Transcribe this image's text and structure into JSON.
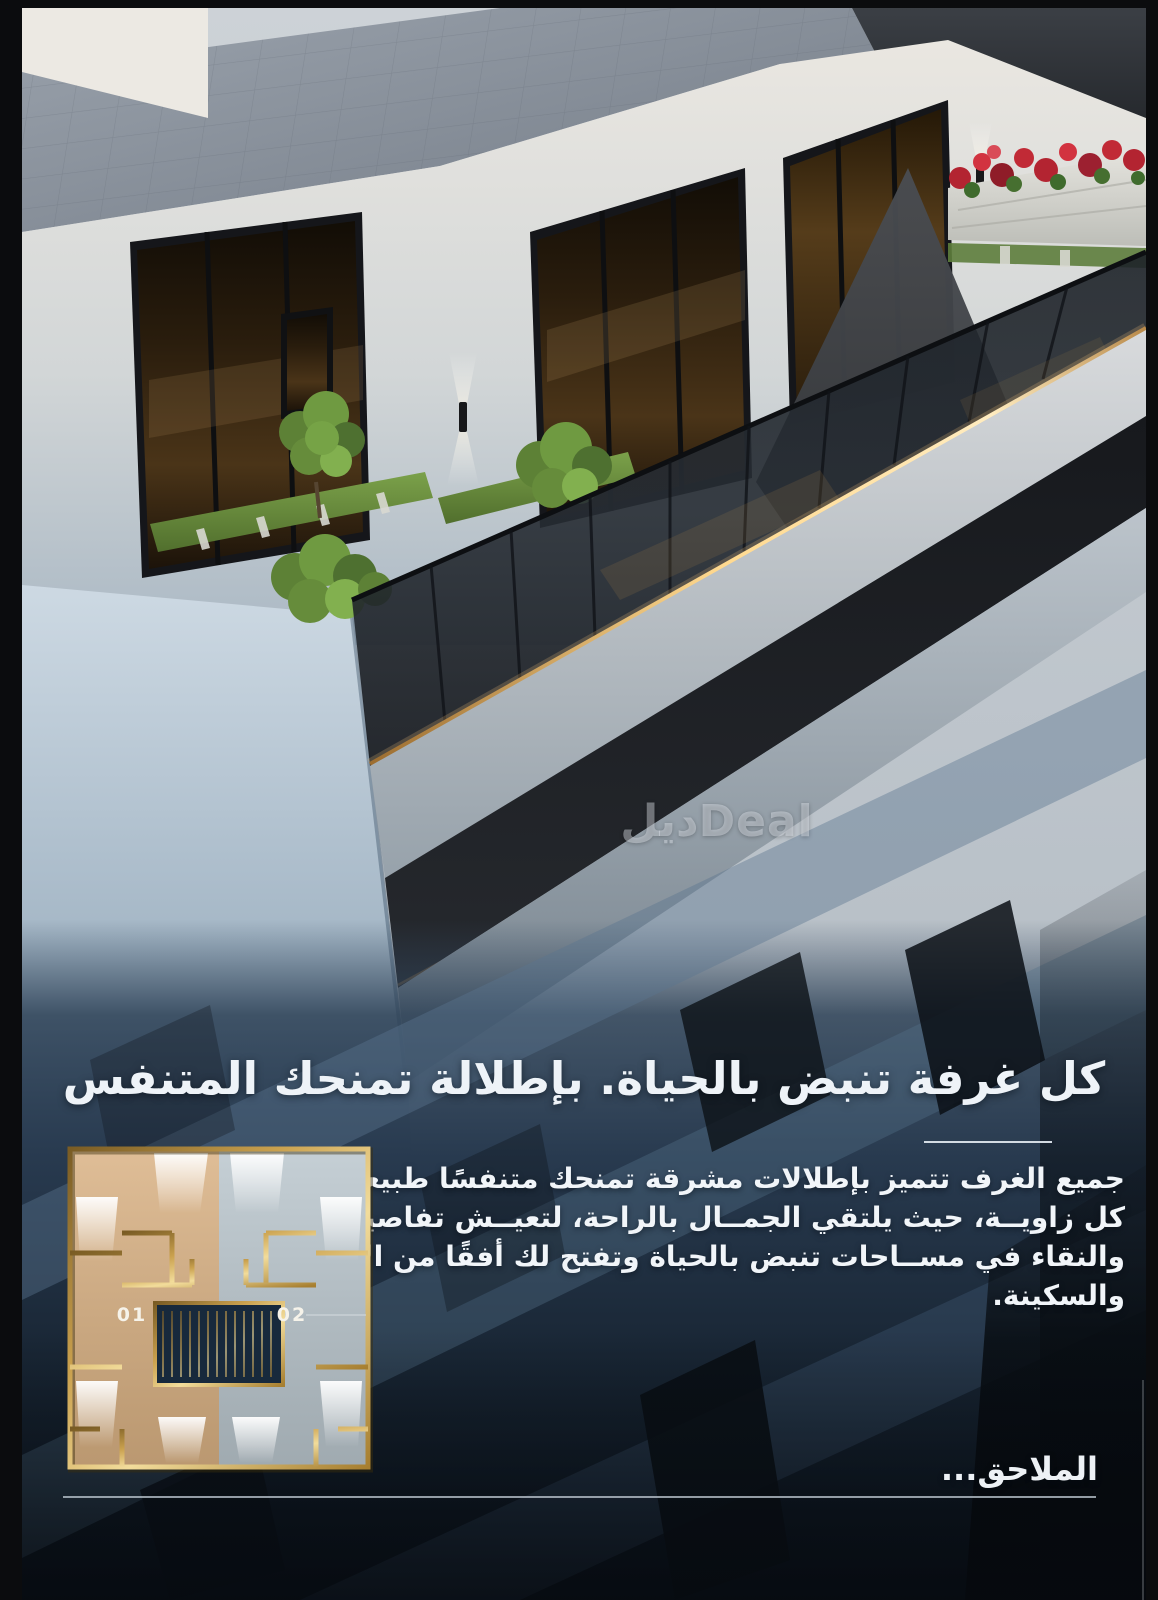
{
  "watermark": {
    "logo_text": "ديلDeal"
  },
  "headline": {
    "text": "كل غرفة تنبض بالحياة. بإطلالة تمنحك المتنفس"
  },
  "paragraph": {
    "lines": [
      "جميع الغرف تتميز بإطلالات مشرقة تمنحك متنفسًا طبيعيًا في",
      "كل زاويــة، حيث يلتقي الجمــال بالراحة، لتعيــش تفاصيل الهدوء",
      "والنقاء في مســاحات تنبض بالحياة وتفتح لك أفقًا من الاتســاع",
      "والسكينة."
    ]
  },
  "floor_plan": {
    "unit_left_label": "01",
    "unit_right_label": "02"
  },
  "footer": {
    "annex_label": "الملاحق..."
  },
  "colors": {
    "accent_gold": "#d9b36a",
    "led_strip": "#ffd98f",
    "navy_background": "#1d2c3e",
    "slate_blue": "#3f5166",
    "text_light": "#f2f6fa",
    "plan_tan": "#d9b183",
    "plan_gray": "#bac6cd",
    "flower_red": "#c12a36",
    "foliage_green": "#6f9a41"
  }
}
